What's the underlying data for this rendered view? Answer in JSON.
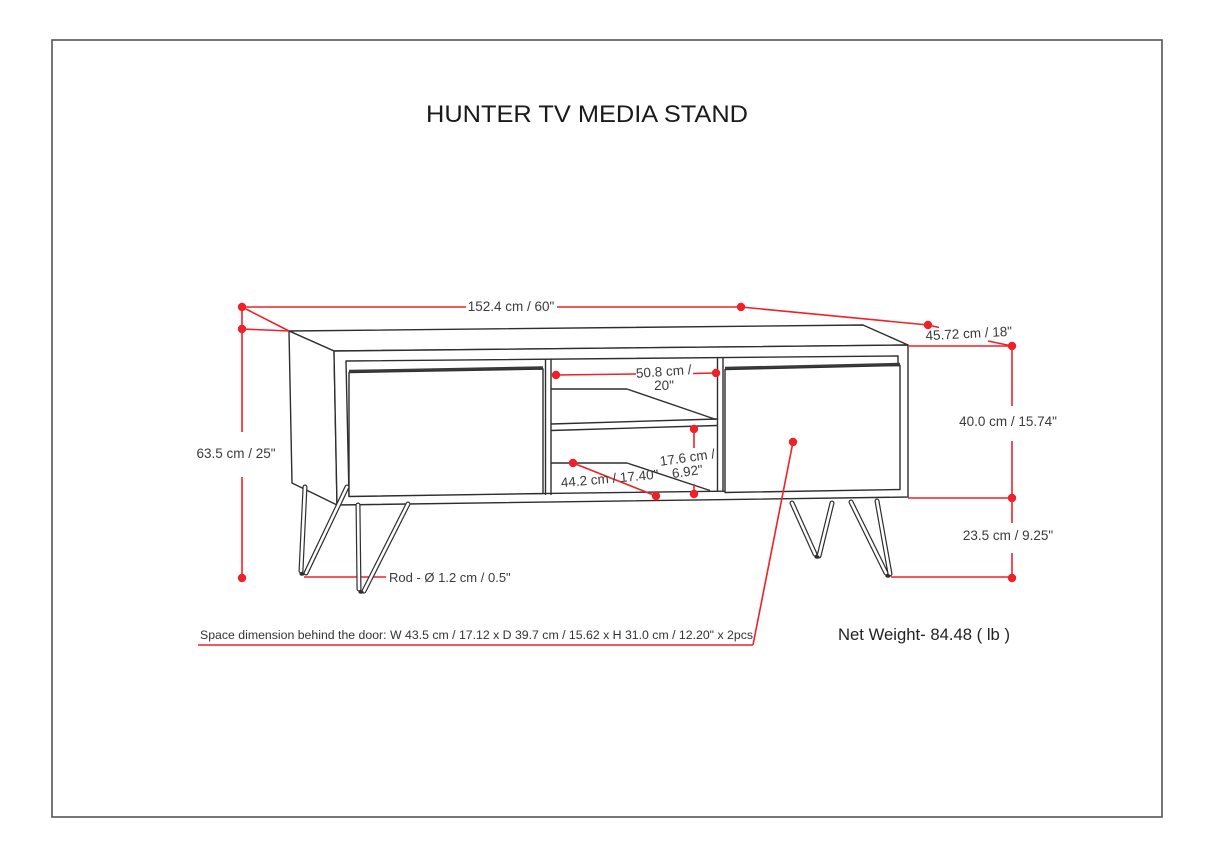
{
  "page": {
    "title": "HUNTER TV MEDIA STAND"
  },
  "dimensions": {
    "overall_width": "152.4 cm / 60\"",
    "overall_depth": "45.72 cm / 18\"",
    "overall_height": "63.5 cm / 25\"",
    "cabinet_height": "40.0 cm / 15.74\"",
    "leg_height": "23.5 cm / 9.25\"",
    "shelf_width_line1": "50.8 cm /",
    "shelf_width_line2": "20\"",
    "shelf_opening_height_line1": "17.6 cm /",
    "shelf_opening_height_line2": "6.92\"",
    "shelf_depth": "44.2 cm / 17.40\"",
    "rod_diameter": "Rod - Ø 1.2 cm / 0.5\"",
    "door_space_note": "Space dimension behind the door:  W 43.5 cm / 17.12 x D 39.7 cm / 15.62 x H 31.0 cm / 12.20\" x 2pcs",
    "net_weight": "Net Weight- 84.48 ( lb )"
  },
  "colors": {
    "dimension_red": "#ee2128",
    "line_black": "#2e2e2e",
    "text_dark": "#3a3a3a"
  }
}
